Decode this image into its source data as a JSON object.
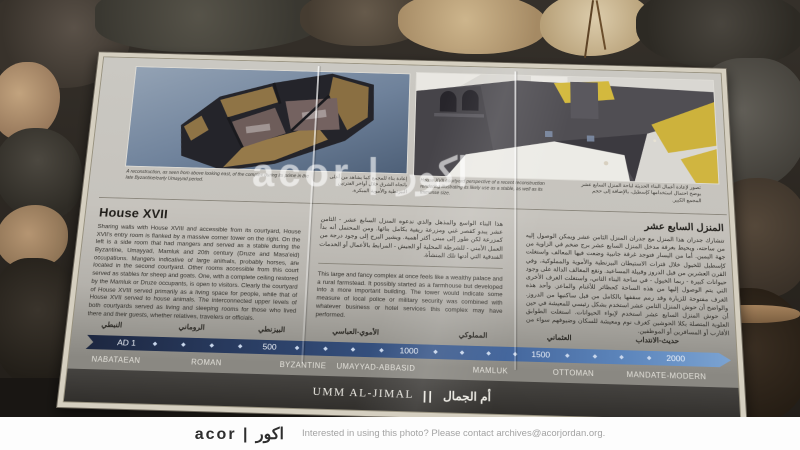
{
  "photo": {
    "watermark": "acor | اكور",
    "footer": {
      "logo": "acor | اكور",
      "contact": "Interested in using this photo? Please contact archives@acorjordan.org."
    }
  },
  "sign": {
    "captions": {
      "left_en": "A reconstruction, as seen from above looking east, of the complex during its prime in the late Byzantine/early Umayyad period.",
      "left_ar": "إعادة بناء للمجمع كما يشاهد من أعلى باتجاه الشرق خلال أواخر الفترتين البيزنطية والأموية المبكرة.",
      "right_en": "House XVII courtyard perspective of a recent reconstruction rendering illustrating its likely use as a stable, as well as its immense size.",
      "right_ar": "تصور لإعادة أعمال البناء الحديثة لباحة المنزل السابع عشر يوضح احتمال استخدامها كإسطبل، بالإضافة إلى حجم المجمع الكبير."
    },
    "house": {
      "heading": "House XVII",
      "body": "Sharing walls with House XVIII and accessible from its courtyard, House XVII's entry room is flanked by a massive corner tower on the right. On the left is a side room that had mangers and served as a stable during the Byzantine, Umayyad, Mamluk and 20th century (Druze and Masa'eid) occupations. Mangers indicative of large animals, probably horses, are located in the second courtyard. Other rooms accessible from this court served as stables for sheep and goats. One, with a complete ceiling restored by the Mamluk or Druze occupants, is open to visitors. Clearly the courtyard of House XVIII served primarily as a living space for people, while that of House XVII served to house animals. The interconnected upper levels of both courtyards served as living and sleeping rooms for those who lived there and their guests, whether relatives, travelers or officials."
    },
    "mid": {
      "ar": "هذا البناء الواسع والمذهل والذي ندعوه المنزل السابع عشر - الثامن عشر يبدو كقصر غني ومزرعة ريفية بكامل بنائها. ومن المحتمل أنه بدأ كمزرعة لكن طور إلى مبنى أكثر أهمية. ويشير البرج إلى وجود درجة من العمل الأمني - للشرطة المحلية أو الجيش - المرابط بالأعمال أو الخدمات الفندقية التي أدتها تلك المنشأة.",
      "en": "This large and fancy complex at once feels like a wealthy palace and a rural farmstead. It possibly started as a farmhouse but developed into a more important building. The tower would indicate some measure of local police or military security was combined with whatever business or hotel services this complex may have performed."
    },
    "right": {
      "heading_ar": "المنزل السابع عشر",
      "body_ar": "تتشارك جدران هذا المنزل مع جدران المنزل الثامن عشر ويمكن الوصول إليه من ساحته، ويحيط بغرفة مدخل المنزل السابع عشر برج ضخم في الزاوية من جهة اليمين. أما من اليسار فتوجد غرفة جانبية وضعت فيها المعالف واستغلت كإسطبل للخيول خلال فترات الاستيطان البيزنطية والأموية والمملوكية، وفي القرن العشرين من قبل الدروز وقبيلة المساعيد. وتقع المعالف الدالة على وجود حيوانات كبيرة - ربما الخيول - في ساحة البناء الثاني، واستغلت الغرف الأخرى التي يتم الوصول إليها من هذه الساحة كحظائر للأغنام والماعز. وأحد هذه الغرف مفتوحة للزيارة وقد رمم سقفها بالكامل من قبل ساكنيها من الدروز. والواضح أن حوش المنزل الثامن عشر استخدم بشكل رئيسي للمعيشة في حين أن حوش المنزل السابع عشر استخدم لإيواء الحيوانات. استغلت الطوابق العلوية المتصلة بكلا الحوشين كغرف نوم ومعيشة للسكان وضيوفهم سواء من الأقارب أو المسافرين أو الموظفين."
    },
    "timeline": {
      "tick": "◆",
      "ar": [
        "النبطي",
        "الروماني",
        "البيزنطي",
        "الأموي-العباسي",
        "المملوكي",
        "العثماني",
        "حديث-الانتداب"
      ],
      "en": [
        "NABATAEAN",
        "ROMAN",
        "BYZANTINE",
        "UMAYYAD-ABBASID",
        "MAMLUK",
        "OTTOMAN",
        "MANDATE-MODERN"
      ],
      "years": [
        "AD 1",
        "500",
        "1000",
        "1500",
        "2000"
      ]
    },
    "banner": {
      "en": "UMM AL-JIMAL",
      "divider": "||",
      "ar": "أم الجمال"
    }
  }
}
